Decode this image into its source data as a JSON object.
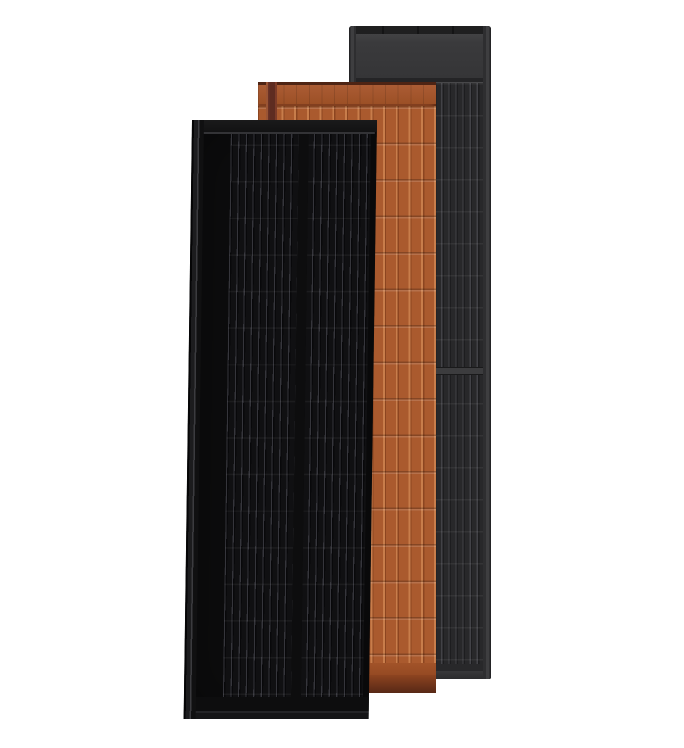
{
  "scene": {
    "type": "product-render",
    "subject": "Three overlapping roof-integrated solar panels standing upright on a white background",
    "background_color": "#ffffff",
    "panels": [
      {
        "id": "panel-anthracite",
        "label": "Anthracite grey solar panel",
        "position": "back-right",
        "style": "dark grey framed module, solid header band on top, vertical cell striping split by a horizontal divider",
        "colors": {
          "body": "#2a2a2c",
          "frame": "#3e3e40",
          "header": "#3a3a3c",
          "stripe": "#424247"
        }
      },
      {
        "id": "panel-terracotta",
        "label": "Terracotta solar roof tile panel",
        "position": "middle",
        "style": "ribbed terracotta tile texture with horizontal tile rows and dark lower edge",
        "colors": {
          "body": "#a8562b",
          "header": "#9c5026",
          "ridge_highlight": "#c87d4b",
          "ridge_shadow": "#8c4520",
          "bottom_band": "#572816"
        }
      },
      {
        "id": "panel-black",
        "label": "All-black solar panel",
        "position": "front-left",
        "style": "matte black module with thin vertical busbar stripes, left mounting rail and central column gap",
        "colors": {
          "body": "#0c0c0d",
          "frame": "#121213",
          "stripe": "#35353b",
          "rail_highlight": "#3b3b3f"
        }
      }
    ]
  }
}
